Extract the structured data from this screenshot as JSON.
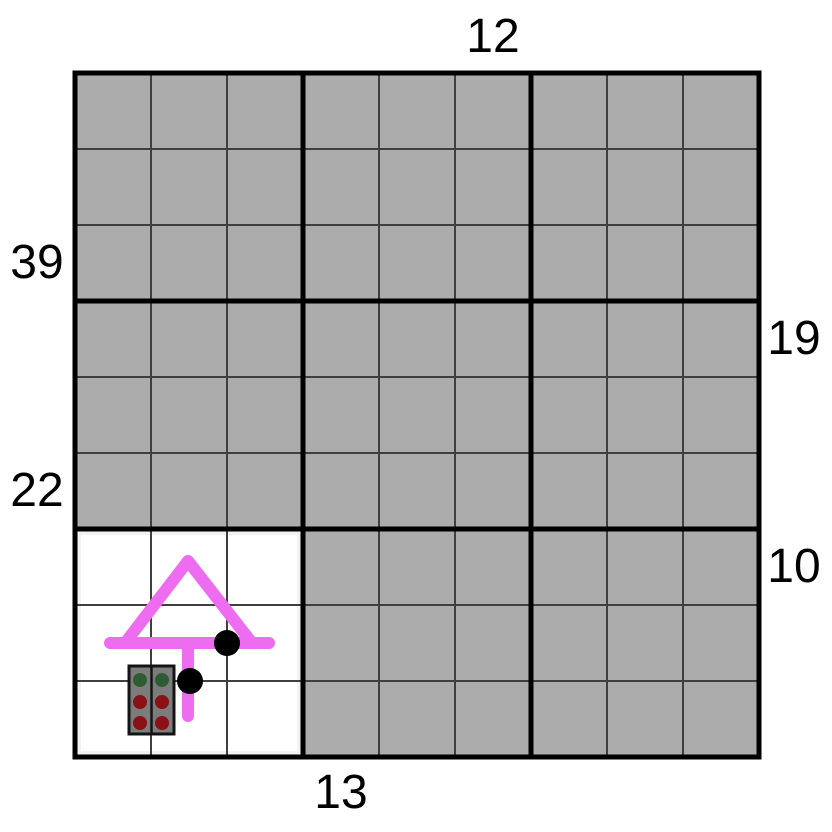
{
  "board": {
    "grid_size": 9,
    "block_size": 3,
    "cell_px": 76,
    "origin_px": {
      "x": 75,
      "y": 73
    },
    "covered_color": "#ACACAC",
    "revealed_color": "#FFFFFF",
    "thin_line_color": "#3F3F3F",
    "thick_line_color": "#000000",
    "revealed_region": {
      "row_start": 7,
      "row_end": 9,
      "col_start": 1,
      "col_end": 3
    }
  },
  "clues": {
    "top": [
      {
        "label": "12",
        "col": 6
      }
    ],
    "bottom": [
      {
        "label": "13",
        "col": 4
      }
    ],
    "left": [
      {
        "label": "39",
        "row": 3
      },
      {
        "label": "22",
        "row": 6
      }
    ],
    "right": [
      {
        "label": "19",
        "row": 4
      },
      {
        "label": "10",
        "row": 7
      }
    ]
  },
  "sprites": {
    "arrow": {
      "color": "#EE6CF0",
      "stroke_width": 12,
      "triangle": {
        "base_left": [
          125,
          643
        ],
        "apex": [
          188,
          561
        ],
        "base_right": [
          252,
          643
        ]
      },
      "base_line": {
        "from": [
          110,
          643
        ],
        "to": [
          269,
          643
        ]
      },
      "stem": {
        "from": [
          188,
          643
        ],
        "to": [
          188,
          716
        ]
      }
    },
    "dots": [
      {
        "cx": 227,
        "cy": 643,
        "r": 13,
        "color": "#000000"
      },
      {
        "cx": 190,
        "cy": 681,
        "r": 13,
        "color": "#000000"
      }
    ],
    "panel": {
      "x": 129,
      "y": 666,
      "width": 45,
      "height": 68,
      "fill": "#7C7C7C",
      "border_color": "#141414",
      "divider_x": 151.5,
      "pip_radius": 7,
      "pip_columns_x": [
        140,
        162
      ],
      "pip_rows": [
        {
          "y": 680,
          "color": "#2D5C33",
          "name": "green"
        },
        {
          "y": 702,
          "color": "#8A1115",
          "name": "red"
        },
        {
          "y": 723,
          "color": "#8A1115",
          "name": "red"
        }
      ]
    }
  }
}
